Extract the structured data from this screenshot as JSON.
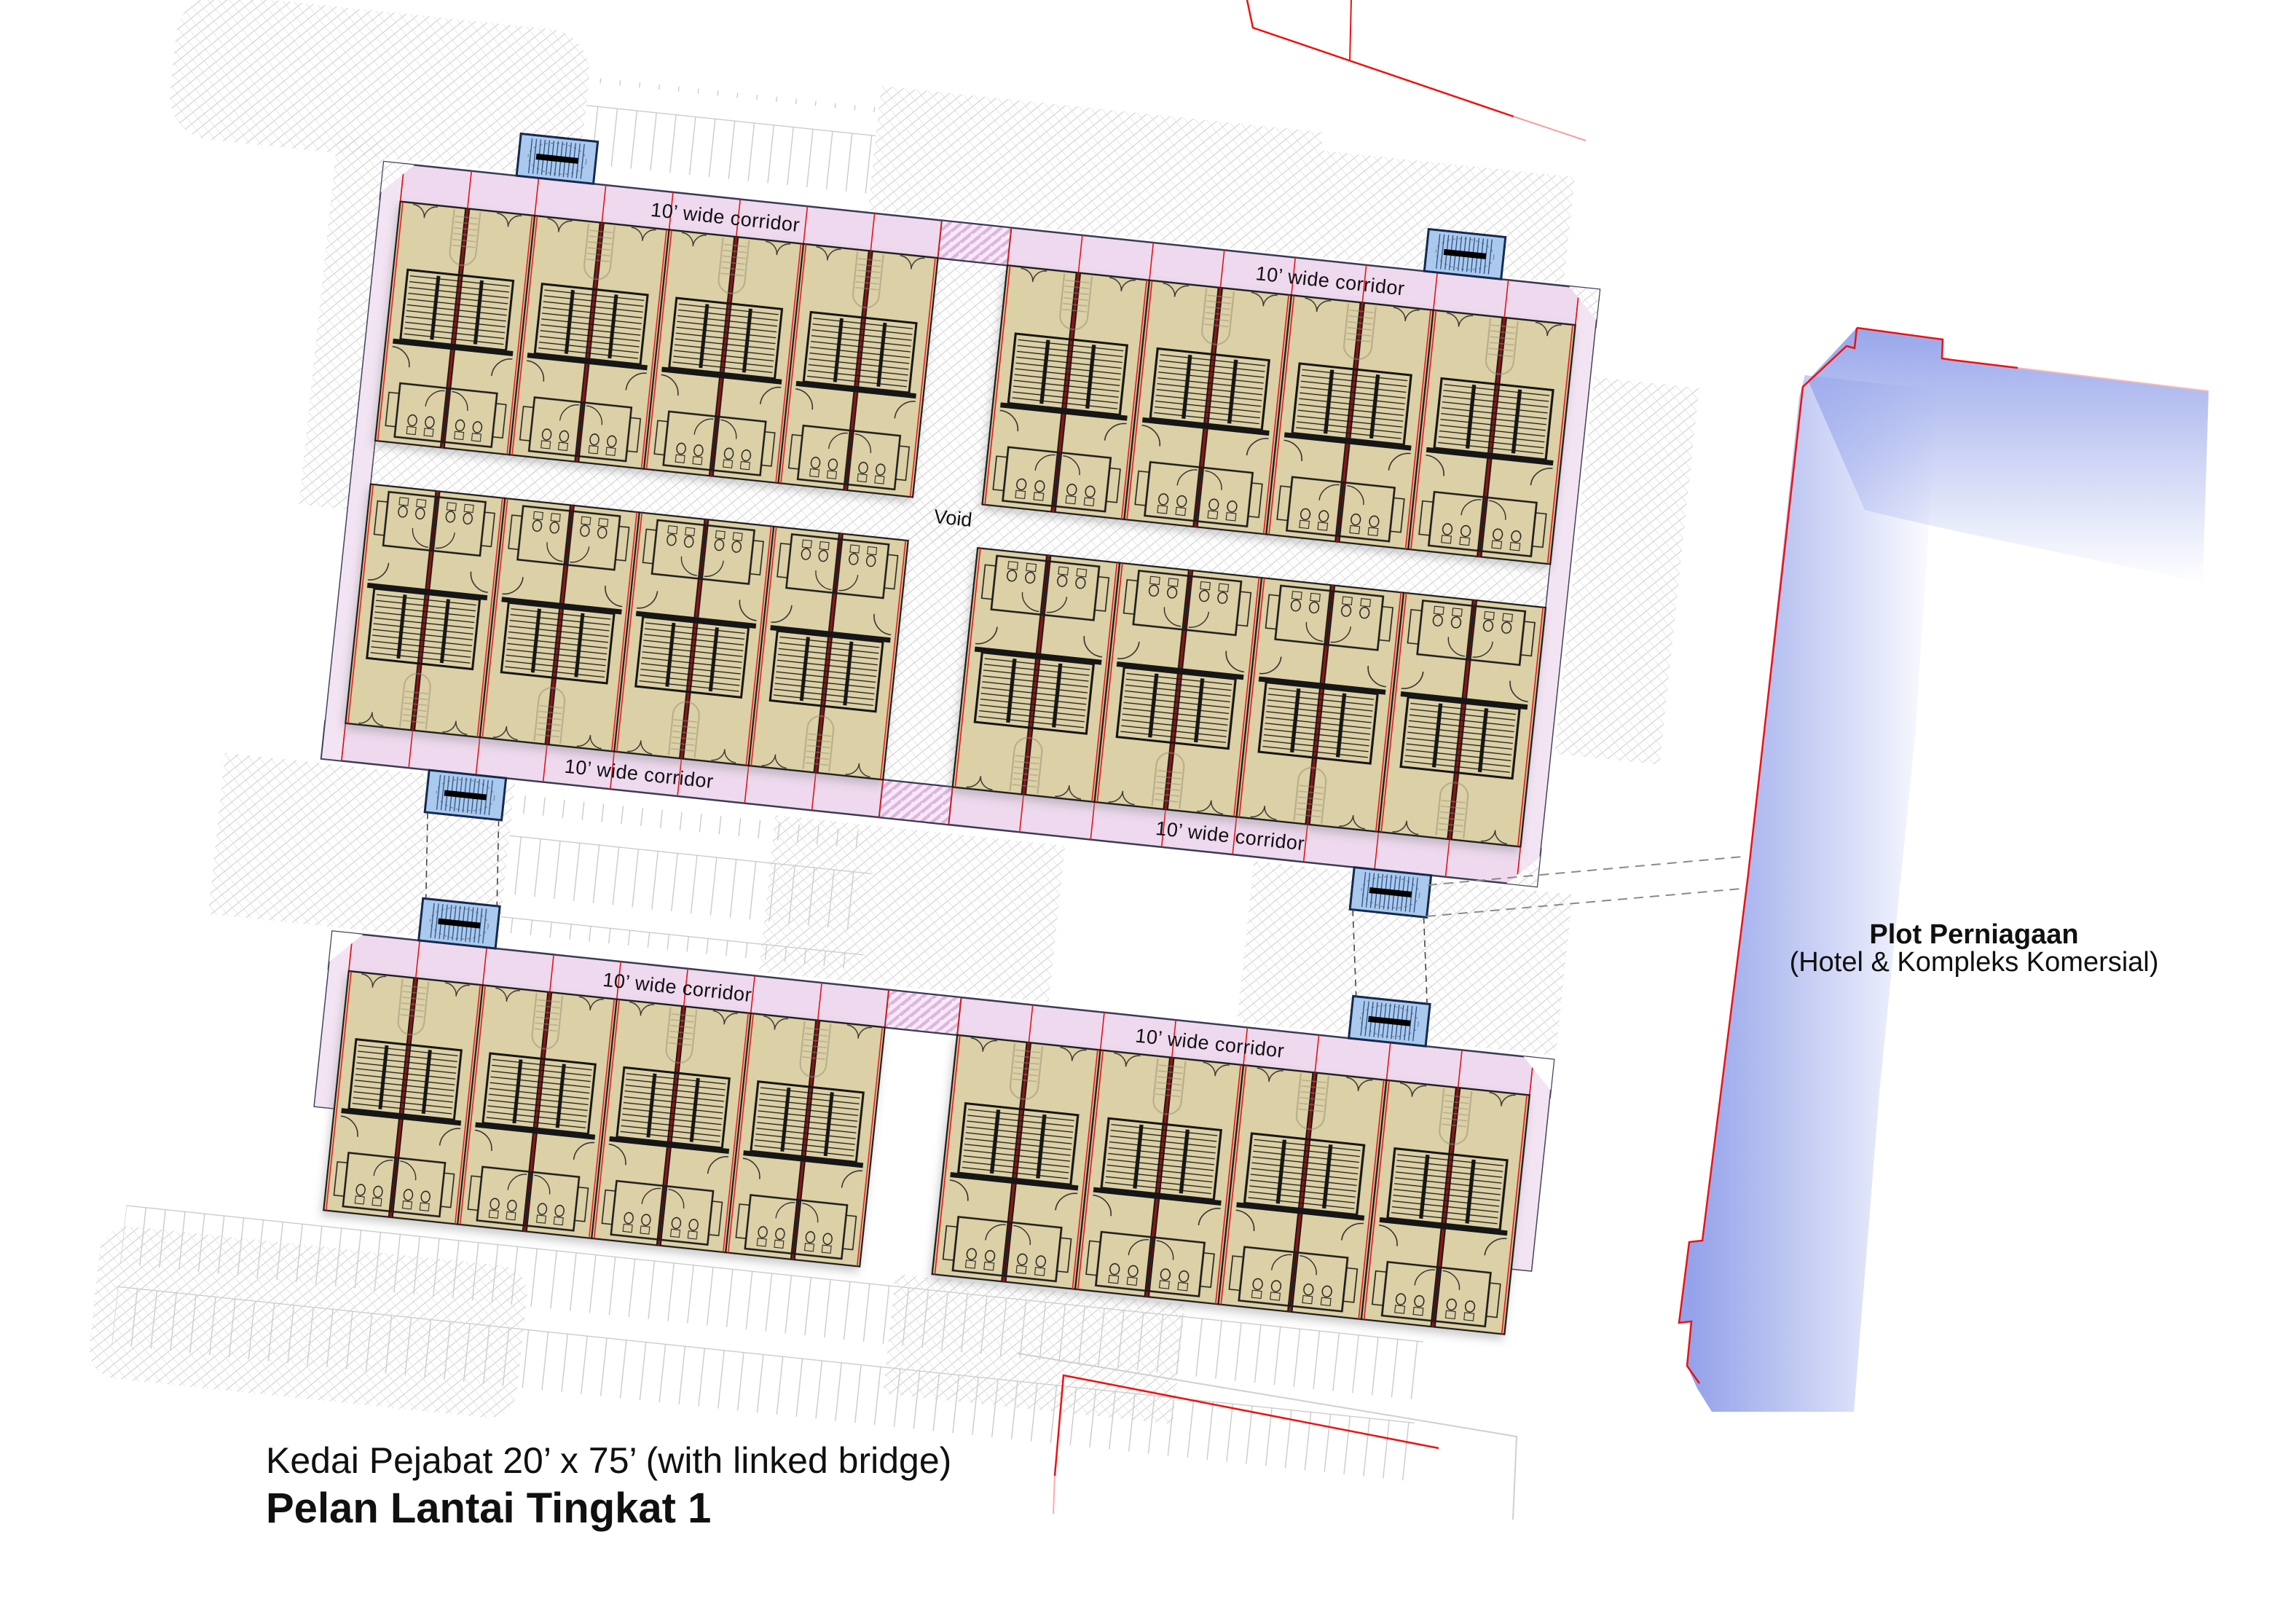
{
  "titles": {
    "subtitle": "Kedai Pejabat 20’ x 75’ (with linked bridge)",
    "title": "Pelan Lantai Tingkat 1"
  },
  "labels": {
    "corridor": "10’ wide corridor",
    "void": "Void"
  },
  "plot": {
    "name": "Plot Perniagaan",
    "description": "(Hotel & Kompleks Komersial)"
  },
  "plan": {
    "corridor_width_ft": 10,
    "unit_size_label": "20' x 75'",
    "blocks": [
      {
        "id": "row1-north-left",
        "pairs": 4,
        "facing": "north"
      },
      {
        "id": "row1-north-right",
        "pairs": 4,
        "facing": "north"
      },
      {
        "id": "row1-south-left",
        "pairs": 4,
        "facing": "south"
      },
      {
        "id": "row1-south-right",
        "pairs": 4,
        "facing": "south"
      },
      {
        "id": "row2-left",
        "pairs": 4,
        "facing": "north"
      },
      {
        "id": "row2-right",
        "pairs": 4,
        "facing": "north"
      }
    ],
    "bridges": 6
  },
  "colors": {
    "corridor_pink": "#eed9ee",
    "unit_tan": "#dcd0a6",
    "bridge_blue": "#a9c9ee",
    "plot_blue": "#93a2ea",
    "boundary_red": "#ee1111",
    "party_wall": "#8c1616"
  }
}
